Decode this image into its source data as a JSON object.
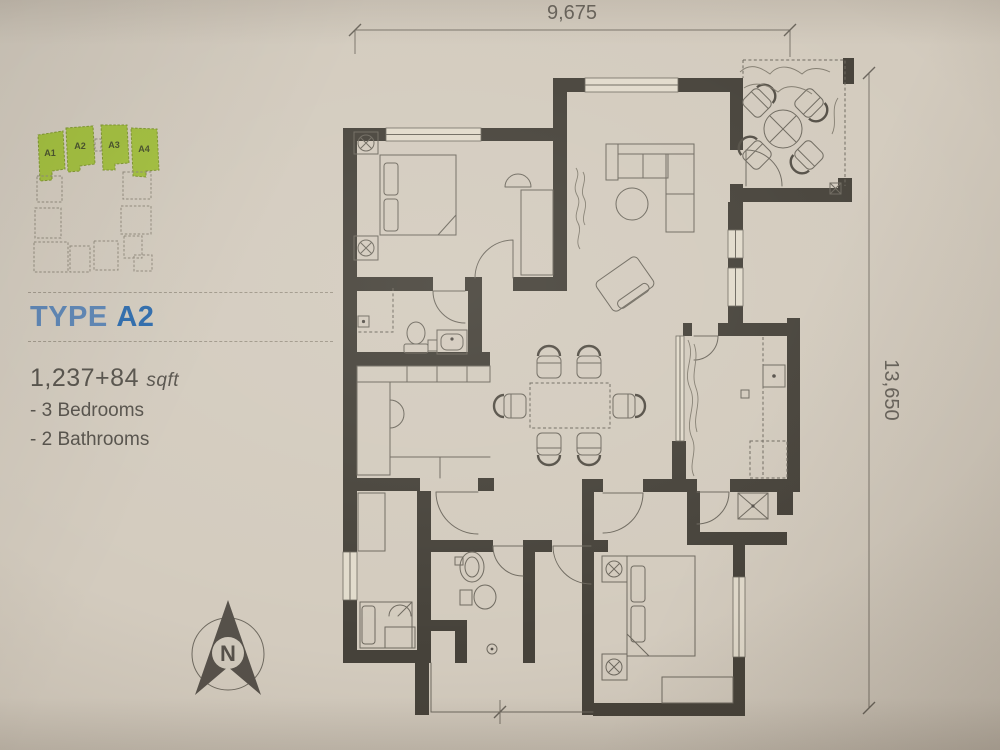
{
  "photo": {
    "paper_color": "#d3cbbe",
    "wall_color": "#46423a",
    "line_color": "#6e695f"
  },
  "key_plan": {
    "highlight_color": "#a2bf3c",
    "units": [
      {
        "label": "A1"
      },
      {
        "label": "A2"
      },
      {
        "label": "A3"
      },
      {
        "label": "A4"
      }
    ]
  },
  "heading": {
    "prefix": "TYPE",
    "value": "A2",
    "prefix_color": "#5b84b4",
    "value_color": "#2b6aac"
  },
  "details": {
    "area": "1,237+84",
    "area_unit": "sqft",
    "features": [
      "- 3 Bedrooms",
      "- 2 Bathrooms"
    ]
  },
  "dimensions": {
    "top": "9,675",
    "right": "13,650"
  },
  "compass": {
    "label": "N"
  }
}
